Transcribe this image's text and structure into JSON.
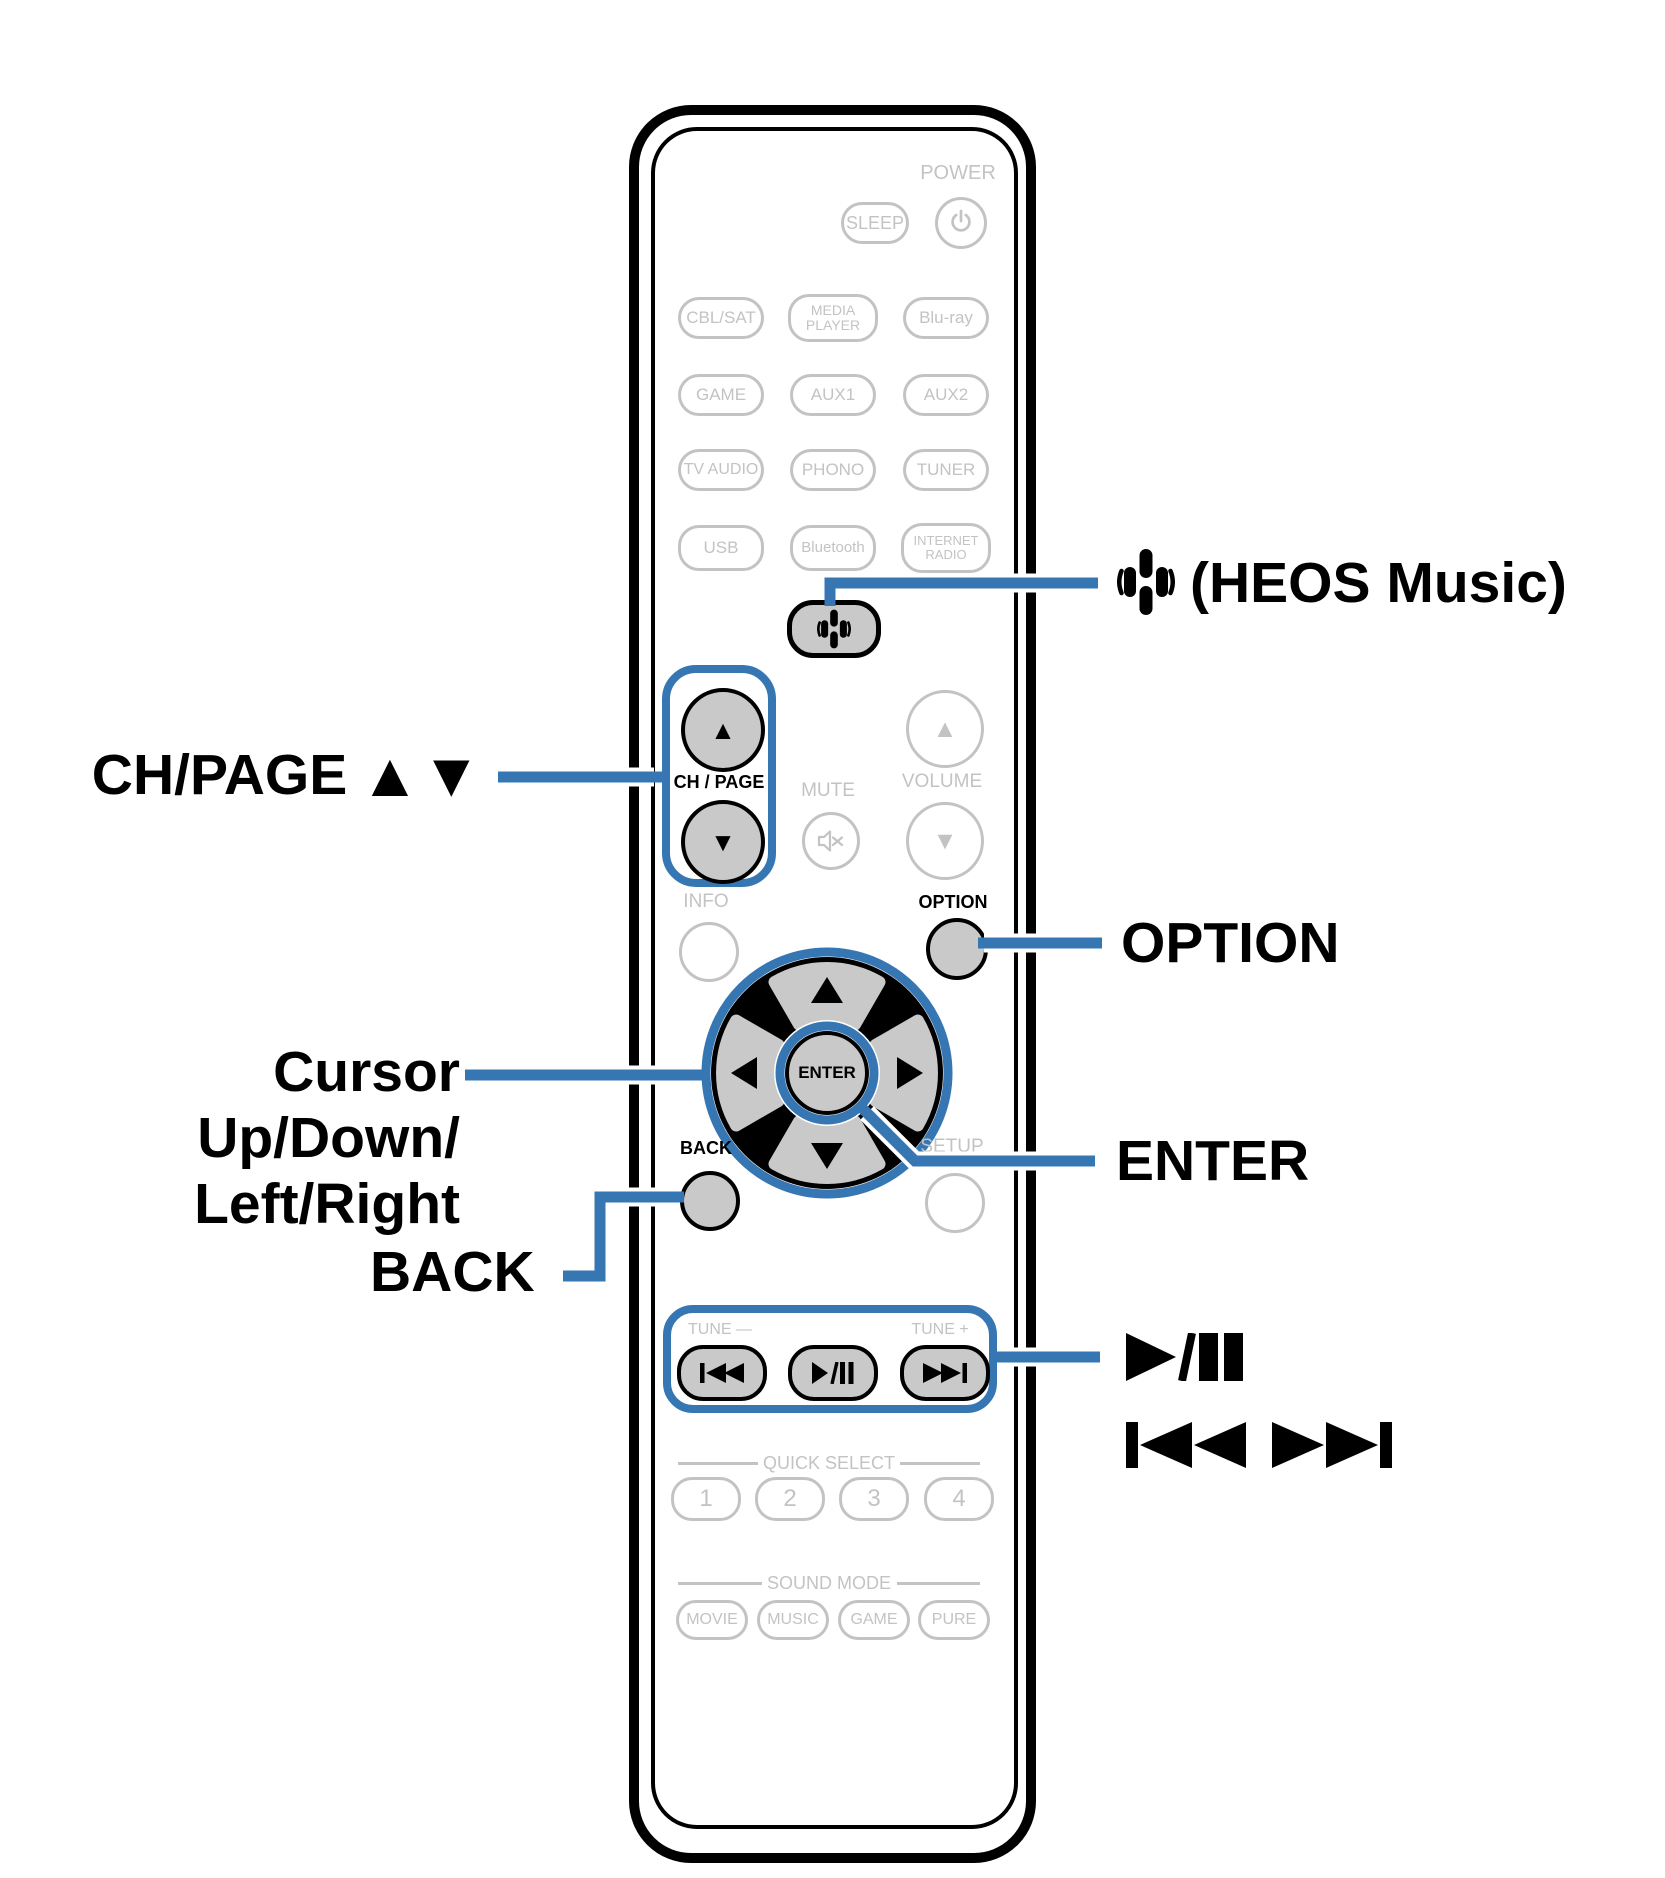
{
  "colors": {
    "accent_blue": "#3677b3",
    "inactive_gray": "#c3c3c3",
    "active_button_fill": "#c9c9c9",
    "outline_black": "#000000"
  },
  "remote": {
    "power_label": "POWER",
    "sleep_label": "SLEEP",
    "power_icon": "power-icon",
    "sources": [
      {
        "label": "CBL/SAT"
      },
      {
        "label": "MEDIA\nPLAYER"
      },
      {
        "label": "Blu-ray"
      },
      {
        "label": "GAME"
      },
      {
        "label": "AUX1"
      },
      {
        "label": "AUX2"
      },
      {
        "label": "TV AUDIO"
      },
      {
        "label": "PHONO"
      },
      {
        "label": "TUNER"
      },
      {
        "label": "USB"
      },
      {
        "label": "Bluetooth"
      },
      {
        "label": "INTERNET\nRADIO"
      }
    ],
    "heos_icon": "heos-music-icon",
    "ch_page_label": "CH / PAGE",
    "mute_label": "MUTE",
    "mute_icon": "mute-speaker-icon",
    "volume_label": "VOLUME",
    "info_label": "INFO",
    "option_label": "OPTION",
    "enter_label": "ENTER",
    "back_label": "BACK",
    "setup_label": "SETUP",
    "tune_minus_label": "TUNE —",
    "tune_plus_label": "TUNE +",
    "transport_icons": [
      "skip-back-icon",
      "play-pause-icon",
      "skip-forward-icon"
    ],
    "quick_select": {
      "label": "QUICK SELECT",
      "buttons": [
        "1",
        "2",
        "3",
        "4"
      ]
    },
    "sound_mode": {
      "label": "SOUND MODE",
      "buttons": [
        "MOVIE",
        "MUSIC",
        "GAME",
        "PURE"
      ]
    }
  },
  "callouts": {
    "heos": {
      "icon": "heos-music-icon",
      "text": "(HEOS Music)"
    },
    "ch_page": {
      "text": "CH/PAGE",
      "arrows": "▲▼"
    },
    "option": {
      "text": "OPTION"
    },
    "cursor": {
      "line1": "Cursor Up/Down/",
      "line2": "Left/Right"
    },
    "enter": {
      "text": "ENTER"
    },
    "back": {
      "text": "BACK"
    },
    "play_pause": {
      "icon": "play-pause-large-icon",
      "text_unicode": "►/▮▮"
    },
    "skip": {
      "icon": "skip-back-forward-large-icon",
      "text_unicode": "▮◄◄ ►►▮"
    }
  }
}
